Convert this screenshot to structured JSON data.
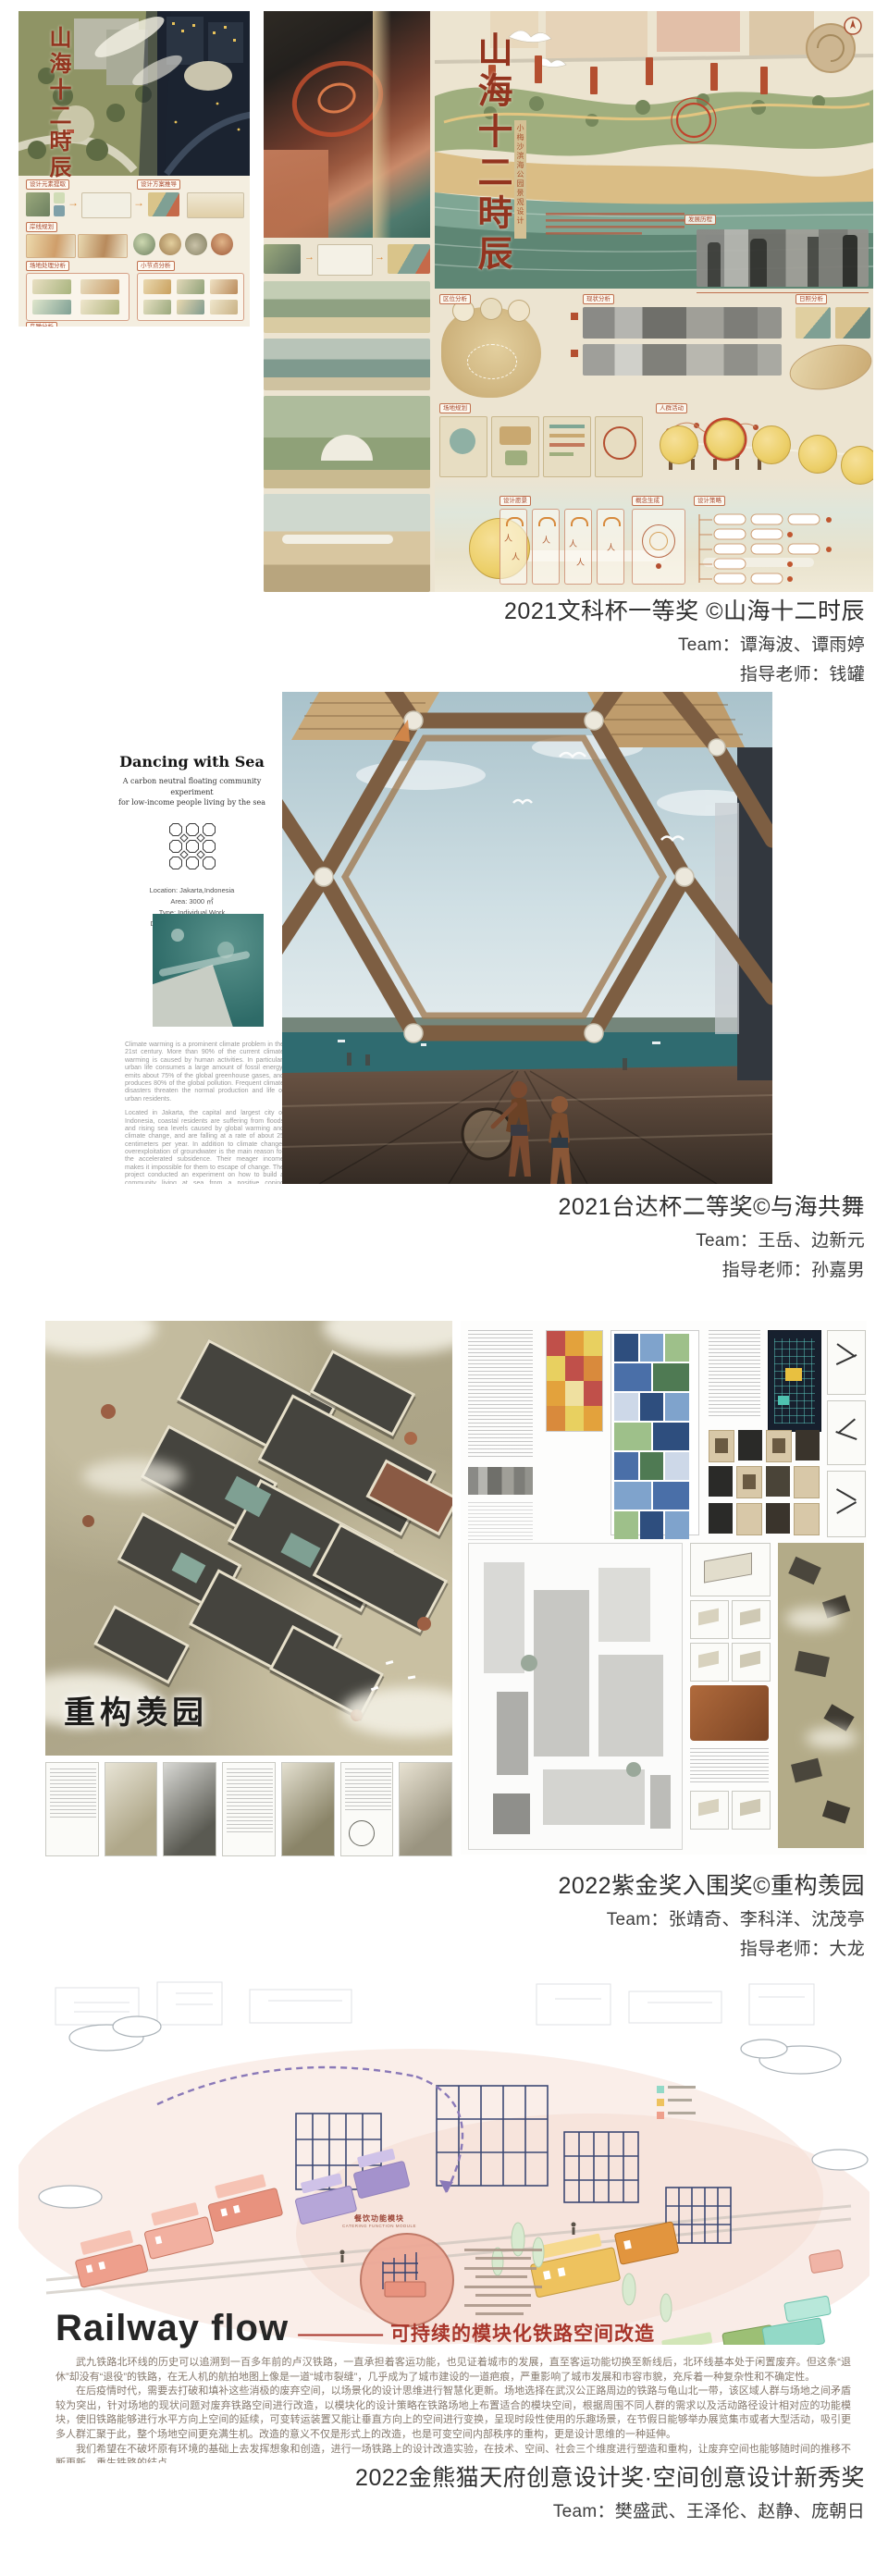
{
  "sections": {
    "s1": {
      "award": "2021文科杯一等奖 ©山海十二时辰",
      "team": "Team：谭海波、谭雨婷",
      "teacher": "指导老师：钱罐",
      "calligraphy": "山海十二時辰",
      "calligraphy_sub": "小梅沙滨海公园景观设计",
      "left_labels": [
        "设计元素提取",
        "设计方案推导",
        "岸线规划",
        "场地处理分析",
        "小节点分析",
        "鸟瞰分析"
      ],
      "right_labels": [
        "发展历程",
        "区位分析",
        "现状分析",
        "日照分析",
        "场地规划",
        "人群活动",
        "设计愿景",
        "概念生成",
        "设计策略"
      ]
    },
    "s2": {
      "award": "2021台达杯二等奖©与海共舞",
      "team": "Team：王岳、边新元",
      "teacher": "指导老师：孙嘉男",
      "title": "Dancing with Sea",
      "subtitle1": "A carbon neutral floating community experiment",
      "subtitle2": "for low-income people living by the sea",
      "meta1": "Location: Jakarta,Indonesia",
      "meta2": "Area: 3000 ㎡",
      "meta3": "Type: Individual Work",
      "meta4": "Duration: 2021.6 — 2021.7",
      "para1": "Climate warming is a prominent climate problem in the 21st century. More than 90% of the current climate warming is caused by human activities. In particular, urban life consumes a large amount of fossil energy, emits about 75% of the global greenhouse gases, and produces 80% of the global pollution. Frequent climate disasters threaten the normal production and life of urban residents.",
      "para2": "Located in Jakarta, the capital and largest city of Indonesia, coastal residents are suffering from floods and rising sea levels caused by global warming and climate change, and are falling at a rate of about 25 centimeters per year. In addition to climate change, overexploitation of groundwater is the main reason for the accelerated subsidence. Their meager income makes it impossible for them to escape of change. The project conducted an experiment on how to build a community living at sea from a positive coping perspective."
    },
    "s3": {
      "award": "2022紫金奖入围奖©重构羡园",
      "team": "Team：张靖奇、李科洋、沈茂亭",
      "teacher": "指导老师：大龙",
      "brush_title": "重构羡园"
    },
    "s4": {
      "award": "2022金熊猫天府创意设计奖·空间创意设计新秀奖",
      "team": "Team：樊盛武、王泽伦、赵静、庞朝日",
      "title": "Railway flow",
      "dashes": "—————",
      "subtitle": "可持续的模块化铁路空间改造",
      "callout": "餐饮功能模块",
      "callout_en": "CATERING FUNCTION MODULE",
      "para1": "武九铁路北环线的历史可以追溯到一百多年前的卢汉铁路，一直承担着客运功能，也见证着城市的发展，直至客运功能切换至新线后，北环线基本处于闲置废弃。但这条“退休”却没有“退役”的铁路，在无人机的航拍地图上像是一道“城市裂缝”，几乎成为了城市建设的一道疤痕，严重影响了城市发展和市容市貌，充斥着一种复杂性和不确定性。",
      "para2": "在后疫情时代，需要去打破和填补这些消极的废弃空间，以场景化的设计思维进行智慧化更新。场地选择在武汉公正路周边的铁路与龟山北一带，该区域人群与场地之间矛盾较为突出，针对场地的现状问题对废弃铁路空间进行改造，以模块化的设计策略在铁路场地上布置适合的模块空间，根据周围不同人群的需求以及活动路径设计相对应的功能模块，使旧铁路能够进行水平方向上空间的延续，可变转运装置又能让垂直方向上的空间进行变换，呈现时段性使用的乐趣场景，在节假日能够举办展览集市或者大型活动，吸引更多人群汇聚于此，整个场地空间更充满生机。改造的意义不仅是形式上的改造，也是可变空间内部秩序的重构，更是设计思维的一种延伸。",
      "para3": "我们希望在不破坏原有环境的基础上去发挥想象和创造，进行一场铁路上的设计改造实验，在技术、空间、社会三个维度进行塑造和重构，让废弃空间也能够随时间的推移不断更新，重生铁路的结点。"
    }
  }
}
